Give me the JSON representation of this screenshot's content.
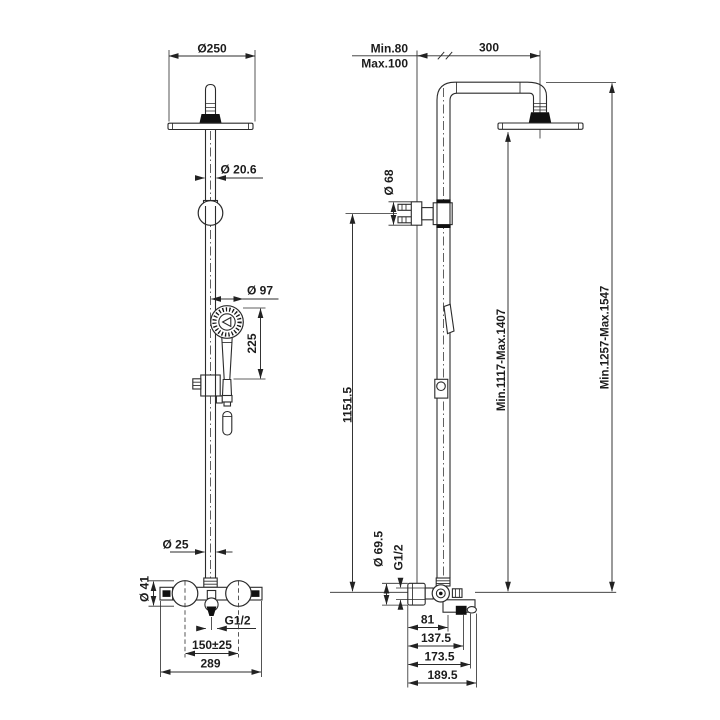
{
  "front_view": {
    "head_diameter": "Ø250",
    "head_pipe_diameter": "Ø 20.6",
    "handshower_diameter": "Ø 97",
    "handshower_length": "225",
    "riser_pipe_diameter": "Ø 25",
    "handle_diameter": "Ø 41",
    "outlet_thread": "G1/2",
    "inlet_spacing": "150±25",
    "mixer_width": "289"
  },
  "side_view": {
    "wall_distance_min": "Min.80",
    "wall_distance_max": "Max.100",
    "arm_projection": "300",
    "bracket_diameter": "Ø 68",
    "rail_height": "1151.5",
    "head_height_range": "Min.1117-Max.1407",
    "overall_height_range": "Min.1257-Max.1547",
    "escutcheon_diameter": "Ø 69.5",
    "outlet_thread": "G1/2",
    "depth_81": "81",
    "depth_137": "137.5",
    "depth_173": "173.5",
    "depth_189": "189.5"
  }
}
